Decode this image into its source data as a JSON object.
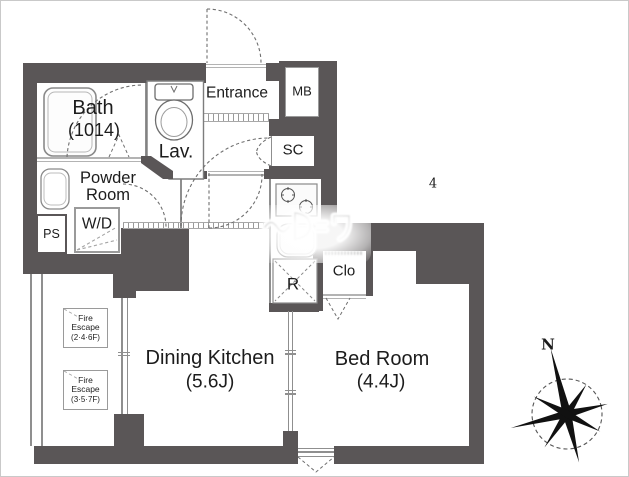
{
  "meta": {
    "page_number": "4",
    "compass_north_label": "N",
    "watermark_text": "(illegible watermark)"
  },
  "colors": {
    "wall": "#5a5657",
    "thin_line": "#8f8f8f",
    "label_text": "#1c1c1c"
  },
  "rooms": {
    "bath": {
      "label": "Bath",
      "size": "(1014)"
    },
    "lav": {
      "label": "Lav."
    },
    "entrance": {
      "label": "Entrance"
    },
    "meter_box": {
      "label": "MB"
    },
    "shoe_closet": {
      "label": "SC"
    },
    "powder_room": {
      "label_line1": "Powder",
      "label_line2": "Room"
    },
    "washer_dryer": {
      "label": "W/D"
    },
    "pipe_space": {
      "label": "PS"
    },
    "dining_kitchen": {
      "label": "Dining Kitchen",
      "size": "(5.6J)"
    },
    "bed_room": {
      "label": "Bed Room",
      "size": "(4.4J)"
    },
    "closet": {
      "label": "Clo"
    },
    "refrigerator": {
      "label": "R"
    },
    "fire_escape_upper": {
      "line1": "Fire",
      "line2": "Escape",
      "line3": "(2·4·6F)"
    },
    "fire_escape_lower": {
      "line1": "Fire",
      "line2": "Escape",
      "line3": "(3·5·7F)"
    }
  }
}
